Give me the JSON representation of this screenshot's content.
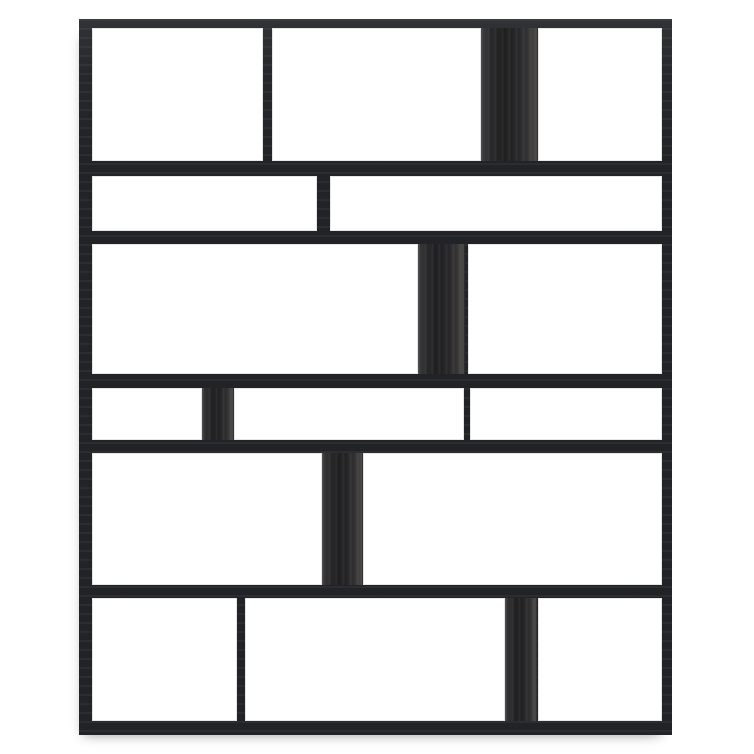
{
  "scene": {
    "width": 754,
    "height": 754,
    "background_color": "#ffffff"
  },
  "unit": {
    "left": 79,
    "top": 19,
    "width": 593,
    "height": 716,
    "frame_color": "#242528",
    "panel_color": "#2b2a2c",
    "cell_color": "#ffffff",
    "rows": [
      {
        "top": 9,
        "height": 133,
        "cells": [
          {
            "kind": "open",
            "left": 13,
            "width": 171
          },
          {
            "kind": "open",
            "left": 193,
            "width": 209
          },
          {
            "kind": "panel",
            "left": 402,
            "width": 57
          },
          {
            "kind": "open",
            "left": 459,
            "width": 124
          }
        ]
      },
      {
        "top": 157,
        "height": 55,
        "cells": [
          {
            "kind": "open",
            "left": 13,
            "width": 225
          },
          {
            "kind": "open",
            "left": 251,
            "width": 332
          }
        ]
      },
      {
        "top": 225,
        "height": 130,
        "cells": [
          {
            "kind": "open",
            "left": 13,
            "width": 326
          },
          {
            "kind": "panel",
            "left": 339,
            "width": 47
          },
          {
            "kind": "open",
            "left": 389,
            "width": 194
          }
        ]
      },
      {
        "top": 369,
        "height": 52,
        "cells": [
          {
            "kind": "open",
            "left": 13,
            "width": 110
          },
          {
            "kind": "panel",
            "left": 123,
            "width": 32
          },
          {
            "kind": "open",
            "left": 155,
            "width": 230
          },
          {
            "kind": "open",
            "left": 391,
            "width": 192
          }
        ]
      },
      {
        "top": 434,
        "height": 132,
        "cells": [
          {
            "kind": "open",
            "left": 13,
            "width": 230
          },
          {
            "kind": "panel",
            "left": 243,
            "width": 41
          },
          {
            "kind": "open",
            "left": 284,
            "width": 299
          }
        ]
      },
      {
        "top": 579,
        "height": 123,
        "cells": [
          {
            "kind": "open",
            "left": 13,
            "width": 145
          },
          {
            "kind": "open",
            "left": 166,
            "width": 260
          },
          {
            "kind": "panel",
            "left": 426,
            "width": 32
          },
          {
            "kind": "open",
            "left": 459,
            "width": 124
          }
        ]
      }
    ]
  }
}
